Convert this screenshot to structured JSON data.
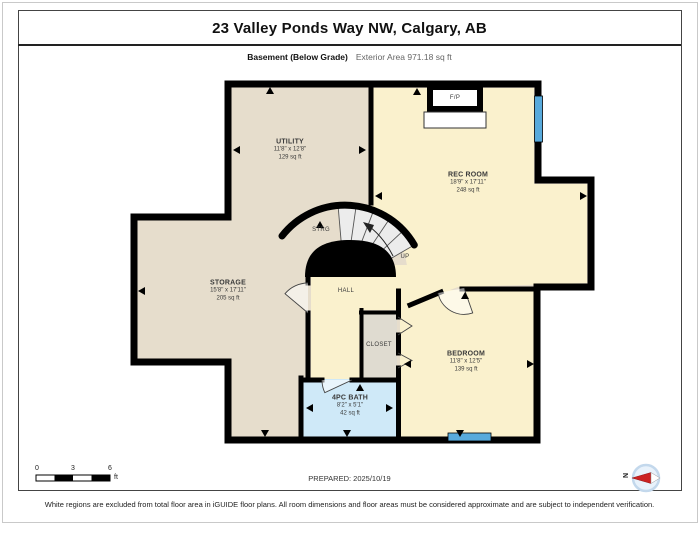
{
  "header": {
    "title": "23 Valley Ponds Way NW, Calgary, AB",
    "floor_label": "Basement (Below Grade)",
    "area_label": "Exterior Area 971.18 sq ft"
  },
  "rooms": {
    "utility": {
      "name": "UTILITY",
      "dims": "11'8\" x 12'8\"",
      "area": "129 sq ft"
    },
    "rec_room": {
      "name": "REC ROOM",
      "dims": "18'9\" x 17'11\"",
      "area": "248 sq ft"
    },
    "storage": {
      "name": "STORAGE",
      "dims": "15'8\" x 17'11\"",
      "area": "205 sq ft"
    },
    "bedroom": {
      "name": "BEDROOM",
      "dims": "11'8\" x 12'5\"",
      "area": "139 sq ft"
    },
    "bath": {
      "name": "4PC BATH",
      "dims": "8'2\" x 5'1\"",
      "area": "42 sq ft"
    },
    "hall": {
      "name": "HALL"
    },
    "closet": {
      "name": "CLOSET"
    },
    "under_stair_storage": {
      "name": "STRG"
    },
    "fireplace": {
      "name": "F/P"
    },
    "stairs": {
      "direction_label": "UP"
    }
  },
  "footer": {
    "scale": {
      "tick0": "0",
      "tick3": "3",
      "tick6": "6",
      "unit": "ft"
    },
    "prepared": "PREPARED: 2025/10/19",
    "compass_label": "N",
    "disclaimer": "White regions are excluded from total floor area in iGUIDE floor plans. All room dimensions and floor areas must be considered approximate and are subject to independent verification."
  },
  "colors": {
    "included_warm": "#e6ddcc",
    "included_yellow": "#faf1cd",
    "bath_blue": "#cfe9f8",
    "closet_greige": "#dfdbd0",
    "stair_gray": "#ececec",
    "window_blue": "#58aadc",
    "wall_black": "#000000"
  }
}
